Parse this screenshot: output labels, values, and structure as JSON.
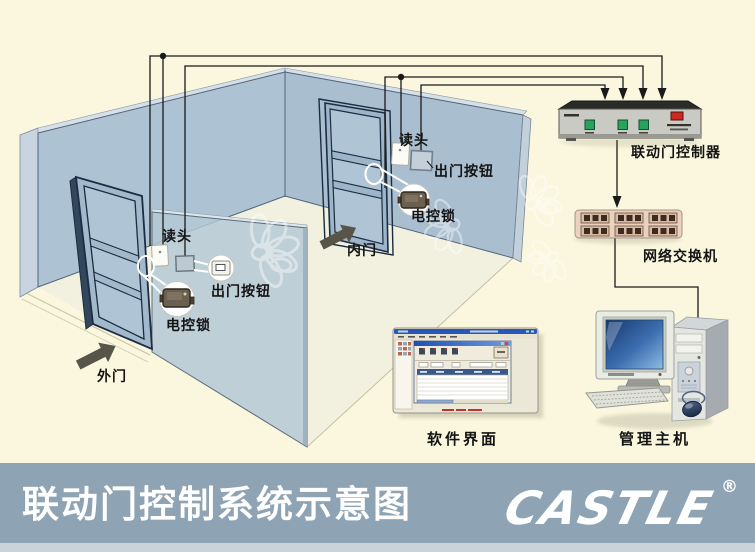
{
  "banner": {
    "title": "联动门控制系统示意图",
    "brand": "CASTLE",
    "registered_mark": "®"
  },
  "diagram": {
    "outer": {
      "door": "外门",
      "reader": "读头",
      "exit_button": "出门按钮",
      "lock": "电控锁"
    },
    "inner": {
      "door": "内门",
      "reader": "读头",
      "exit_button": "出门按钮",
      "lock": "电控锁"
    },
    "controller": "联动门控制器",
    "network_switch": "网络交换机",
    "software": "软件界面",
    "host": "管理主机"
  },
  "colors": {
    "background": "#FAF7DE",
    "banner": "#8EA4B4",
    "banner_bottom_strip": "#CBD3DA",
    "wall": "#ADC2D3",
    "wall_edge": "#C8D5E0",
    "divider_pane": "#B5C8D5",
    "door": "#A2B9CC",
    "floor": "#F2F0DF",
    "wire": "#1A1A1A",
    "led_green": "#27A35C",
    "power_red": "#C92B20",
    "switch_body": "#E9D2BE",
    "port_dark": "#3E2B20",
    "screen_blue": "#2F62A8",
    "label_text": "#141414",
    "banner_text": "#FFFFFF"
  }
}
